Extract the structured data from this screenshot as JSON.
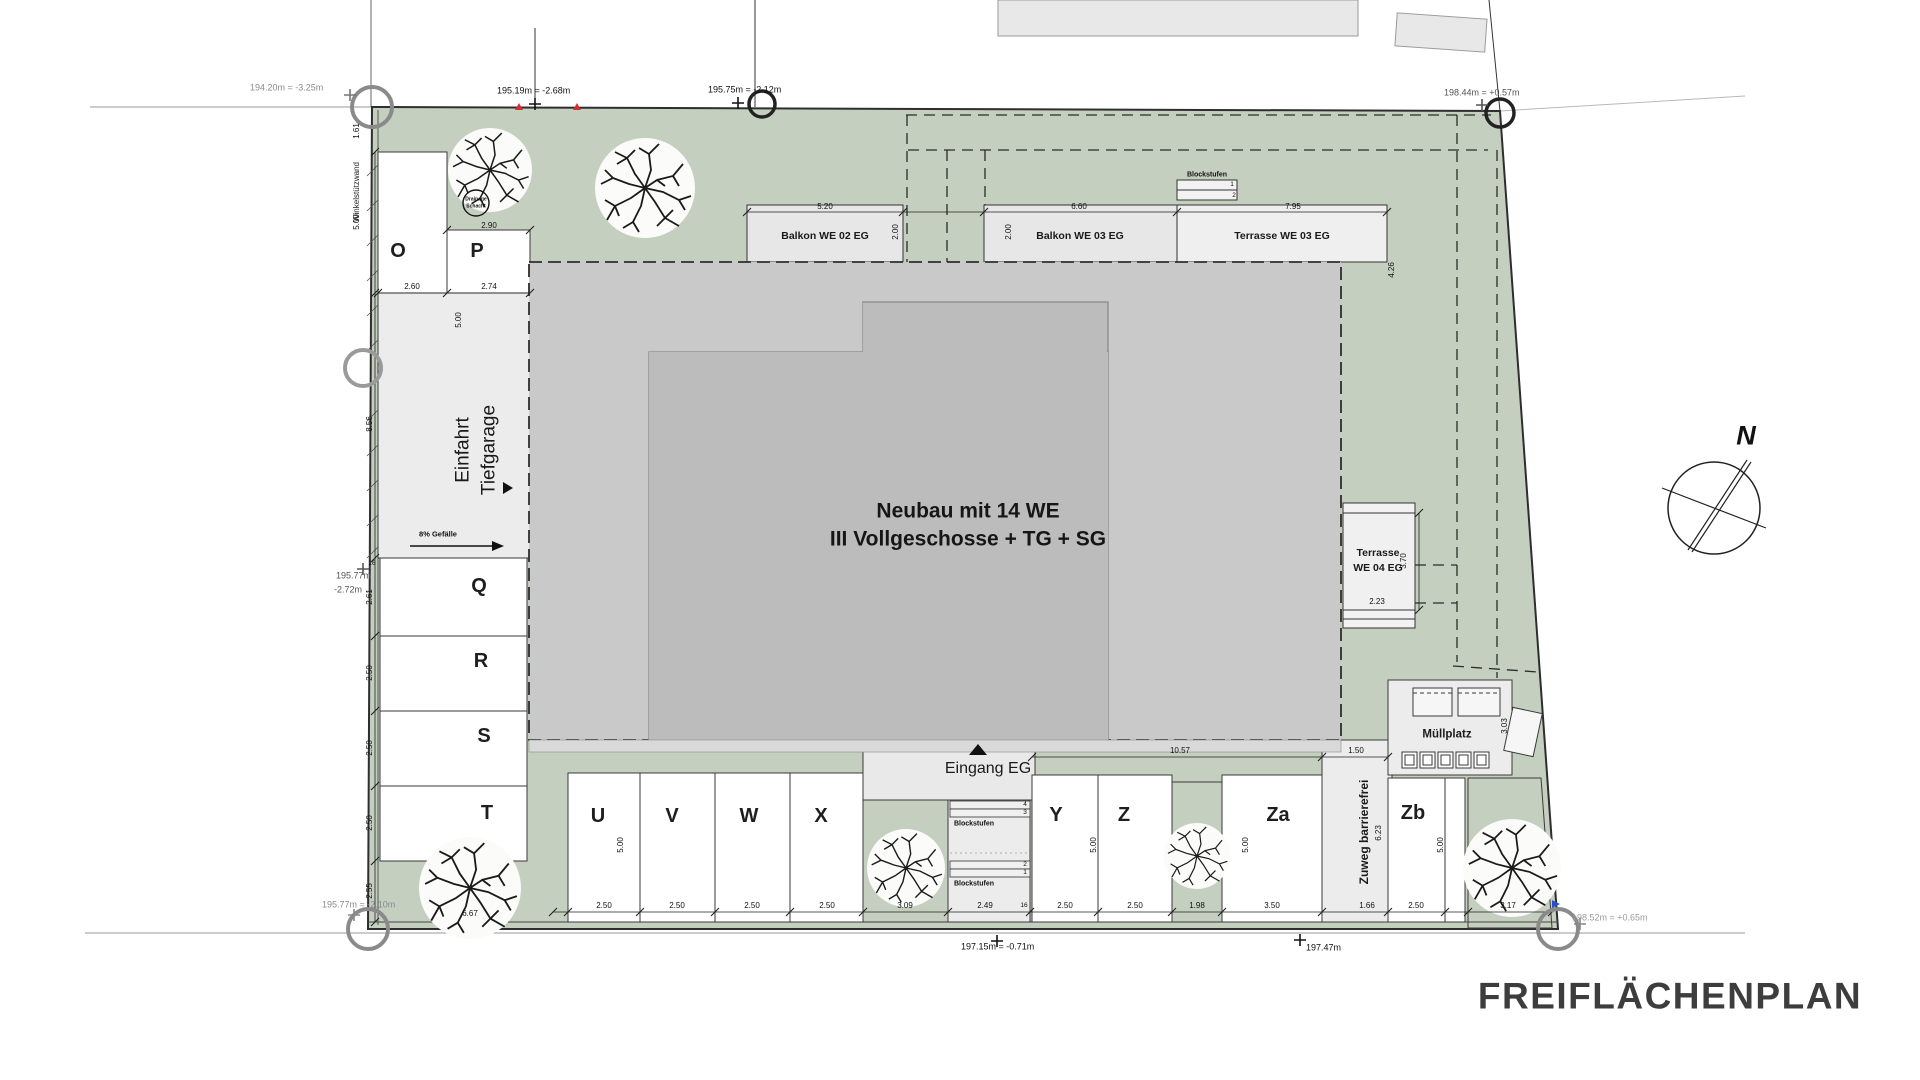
{
  "title": "FREIFLÄCHENPLAN",
  "north_label": "N",
  "building": {
    "line1": "Neubau mit 14 WE",
    "line2": "III Vollgeschosse + TG + SG"
  },
  "labels": {
    "einfahrt_line1": "Einfahrt",
    "einfahrt_line2": "Tiefgarage",
    "gefaelle": "8% Gefälle",
    "eingang": "Eingang EG",
    "zuweg": "Zuweg barrierefrei",
    "muellplatz": "Müllplatz",
    "winkelstuetzwand": "Winkelstützwand",
    "drainage_line1": "Drainage",
    "drainage_line2": "Schacht",
    "blockstufen_top": "Blockstufen",
    "blockstufen_upper": "Blockstufen",
    "blockstufen_lower": "Blockstufen",
    "balkon_we02": "Balkon WE 02 EG",
    "balkon_we03": "Balkon WE 03 EG",
    "terrasse_we03": "Terrasse WE 03 EG",
    "terrasse_we04_line1": "Terrasse",
    "terrasse_we04_line2": "WE 04 EG"
  },
  "parking": {
    "stalls": [
      "O",
      "P",
      "Q",
      "R",
      "S",
      "T",
      "U",
      "V",
      "W",
      "X",
      "Y",
      "Z",
      "Za",
      "Zb"
    ]
  },
  "survey": {
    "tl": "194.20m = -3.25m",
    "top1": "195.19m = -2.68m",
    "top2": "195.75m = -2.12m",
    "tr": "198.44m = +0.57m",
    "left1": "195.77m",
    "left2": "-2.72m",
    "bl": "195.77m = -2.10m",
    "bottom1": "197.15m = -0.71m",
    "bottom2": "197.47m",
    "br": "198.52m = +0.65m"
  },
  "dims": {
    "strip": "1.61",
    "o_d": "5.00",
    "o_w": "2.60",
    "p_w_top": "2.90",
    "p_w": "2.74",
    "p_d": "5.00",
    "ramp": "8.56",
    "q": "2.61",
    "r": "2.50",
    "s": "2.50",
    "t": "2.50",
    "t2": "2.55",
    "t16": "16",
    "tree_bl": "6.67",
    "u": "2.50",
    "v": "2.50",
    "w": "2.50",
    "x": "2.50",
    "row1_d": "5.00",
    "tree_x": "3.09",
    "entr": "2.49",
    "entr16": "16",
    "y": "2.50",
    "z": "2.50",
    "gap": "1.98",
    "za": "3.50",
    "y_d": "5.00",
    "za_d": "5.00",
    "zb_d": "5.00",
    "zuweg_w": "1.50",
    "row2": "10.57",
    "zuweg_l": "6.23",
    "zuweg_b": "1.66",
    "zb": "2.50",
    "tree_br": "3.17",
    "mp": "3.03",
    "b02_w": "5.20",
    "b02_d": "2.00",
    "b03_w": "6.60",
    "b03_d": "2.00",
    "t03_w": "7.95",
    "t03_d": "4.26",
    "t04_d": "3.70",
    "t04_w": "2.23"
  },
  "steps": {
    "top": [
      "1",
      "2"
    ],
    "entrance_upper": [
      "4",
      "3"
    ],
    "entrance_lower": [
      "2",
      "1"
    ]
  },
  "colors": {
    "green": "#c5cfc0",
    "building": "#bcbcbc",
    "tg_outline": "#c9c9c9",
    "paved": "#ececec",
    "title_text": "#3d3d3d",
    "marker_red": "#d03030",
    "marker_blue": "#2a52c8"
  }
}
